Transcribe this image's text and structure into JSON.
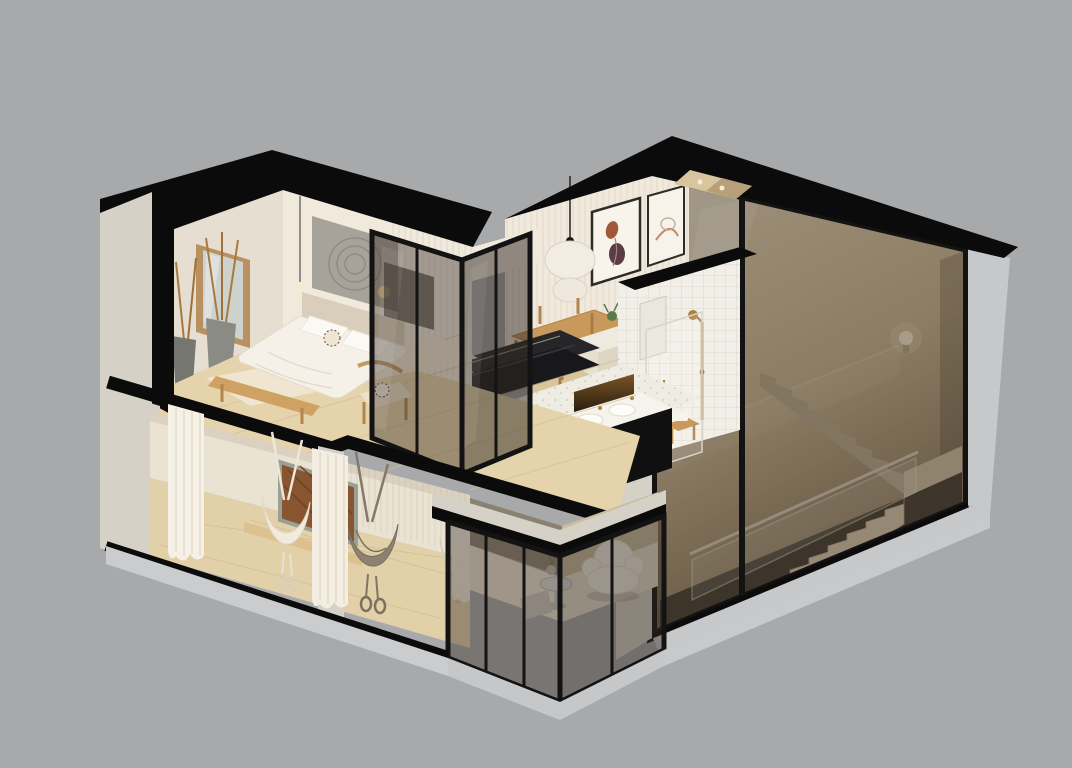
{
  "scene": {
    "title": "Isometric cutaway 3D render of a two-storey apartment on a grey background",
    "render_style": "architectural dollhouse section, roof and front walls cut away (black section fills)",
    "background": "plain grey, no text or UI controls visible",
    "floors": [
      {
        "name": "upper floor",
        "rooms": [
          {
            "name": "bedroom",
            "objects": [
              "double bed with white linen",
              "beige headboard",
              "wood bench",
              "leaning wood-framed mirror",
              "two stone vases with dried branches",
              "mandala wall hanging",
              "rattan armchair with patterned cushion",
              "pendant bulb light",
              "round wall sconce",
              "pale rug",
              "light wood plank floor"
            ]
          },
          {
            "name": "glass wardrobe box",
            "objects": [
              "black-framed smoked glass partition walls",
              "dark TV panel behind glass"
            ]
          },
          {
            "name": "dining room",
            "objects": [
              "long wooden dining table",
              "wooden chairs",
              "white double-globe pendant lamp",
              "two abstract framed prints",
              "white slatted wall"
            ]
          },
          {
            "name": "kitchen and living corner",
            "objects": [
              "dark charcoal sofa",
              "light kitchen island with plant",
              "double vanity with white counter, two basins and black front",
              "backlit niche panel",
              "terrazzo floor"
            ]
          },
          {
            "name": "bathroom",
            "objects": [
              "white square-tile walls",
              "brass shower column",
              "glass shower screen",
              "wood stool with white towel",
              "wall mirror"
            ]
          }
        ]
      },
      {
        "name": "lower floor",
        "rooms": [
          {
            "name": "aerial yoga room",
            "objects": [
              "white fabric hammock",
              "taupe fabric hammock",
              "small white hammock",
              "carved wood wall panel",
              "low wood bench",
              "white curtains",
              "wood plank floor"
            ]
          },
          {
            "name": "lounge",
            "objects": [
              "white boucle armchair",
              "chrome side table",
              "vase with green stems",
              "metal bucket",
              "fluted glass panel",
              "smoked glass walls"
            ]
          },
          {
            "name": "stairwell",
            "objects": [
              "concrete stair lower flight",
              "intermediate landing",
              "upper flight",
              "glass balustrade with round handrail",
              "wall rail",
              "round wall sconce",
              "full-height tinted glazing"
            ]
          }
        ]
      }
    ]
  },
  "colors": {
    "bg": "#a8a9ab",
    "cut": "#0b0b0b",
    "facade": "#d6d1c7",
    "exterior": "#c7c8ca",
    "plinth": "#cbccce",
    "wall_warm": "#f0e9dc",
    "wall_shade": "#e6ded0",
    "wood_floor": "#e4d3ab",
    "wood_furn": "#c9995c",
    "tile": "#f2efe8",
    "brass": "#ad823f",
    "linen": "#f5f1e8",
    "dark_sofa": "#18181c",
    "frame": "#131313",
    "taupe": "#8d8272",
    "white_furn": "#f3efe6",
    "glass_tint": "rgba(58,46,36,0.42)",
    "stair_light": "#e9d9bb",
    "stair_dark": "#8f7d63"
  }
}
